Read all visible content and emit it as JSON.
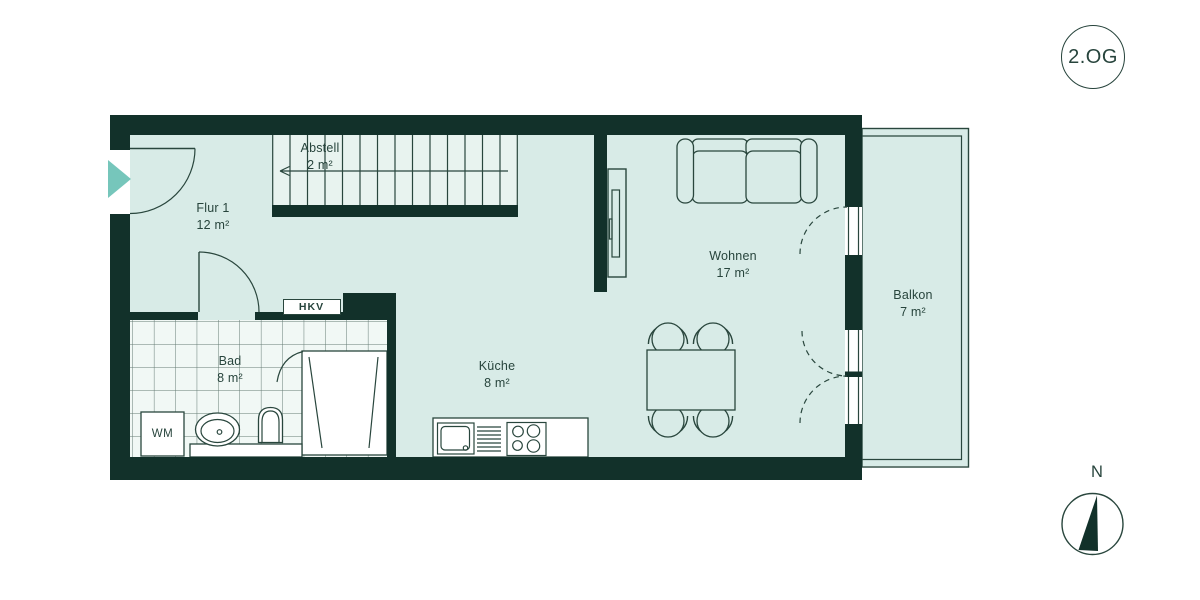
{
  "floor_badge": "2.OG",
  "compass": {
    "label": "N"
  },
  "rooms": [
    {
      "id": "flur",
      "name": "Flur 1",
      "area": "12 m²"
    },
    {
      "id": "abstell",
      "name": "Abstell",
      "area": "2 m²"
    },
    {
      "id": "bad",
      "name": "Bad",
      "area": "8 m²"
    },
    {
      "id": "kueche",
      "name": "Küche",
      "area": "8 m²"
    },
    {
      "id": "wohnen",
      "name": "Wohnen",
      "area": "17 m²"
    },
    {
      "id": "balkon",
      "name": "Balkon",
      "area": "7 m²"
    }
  ],
  "fixtures": {
    "heating_distributor": "HKV",
    "washing_machine": "WM"
  },
  "colors": {
    "wall_color": "#12312a",
    "floor_color": "#d8ebe7",
    "stairs_color": "#e8f3ef",
    "tile_color": "#f1f8f5",
    "accent_color": "#76c6bb",
    "line_color": "#29463d",
    "text_color": "#27443c"
  }
}
